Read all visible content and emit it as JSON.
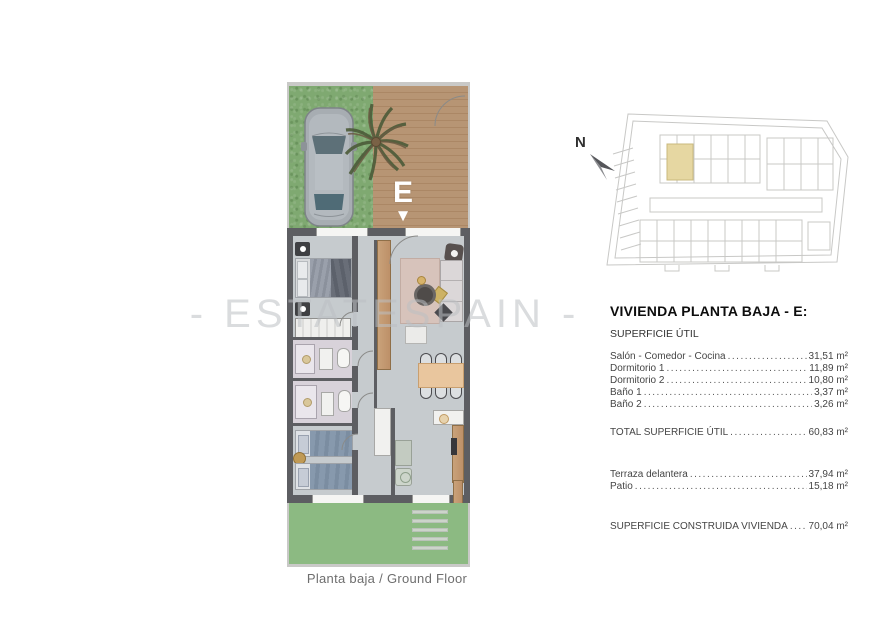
{
  "watermark": "- ESTATESPAIN -",
  "caption": "Planta baja / Ground Floor",
  "plan": {
    "unit_letter": "E",
    "entrance_arrow": "▼"
  },
  "compass": {
    "label": "N"
  },
  "details": {
    "title": "VIVIENDA PLANTA BAJA - E:",
    "section_label": "SUPERFICIE ÚTIL",
    "rooms": [
      {
        "label": "Salón - Comedor - Cocina",
        "value": "31,51 m²"
      },
      {
        "label": "Dormitorio 1",
        "value": "11,89 m²"
      },
      {
        "label": "Dormitorio 2",
        "value": "10,80 m²"
      },
      {
        "label": "Baño 1",
        "value": "3,37 m²"
      },
      {
        "label": "Baño 2",
        "value": "3,26 m²"
      }
    ],
    "total": {
      "label": "TOTAL SUPERFICIE ÚTIL",
      "value": "60,83 m²"
    },
    "outdoor": [
      {
        "label": "Terraza delantera",
        "value": "37,94 m²"
      },
      {
        "label": "Patio",
        "value": "15,18 m²"
      }
    ],
    "built": {
      "label": "SUPERFICIE CONSTRUIDA VIVIENDA",
      "value": "70,04 m²"
    }
  },
  "colors": {
    "grass": "#7fa971",
    "patio_grass": "#8cba82",
    "deck_wood": "#b79574",
    "interior_floor": "#c6cbce",
    "wall": "#5d5e62",
    "highlighted_unit": "#e6d7a2",
    "bed_blue": "#8799ad",
    "furniture_wood": "#c49c72"
  }
}
